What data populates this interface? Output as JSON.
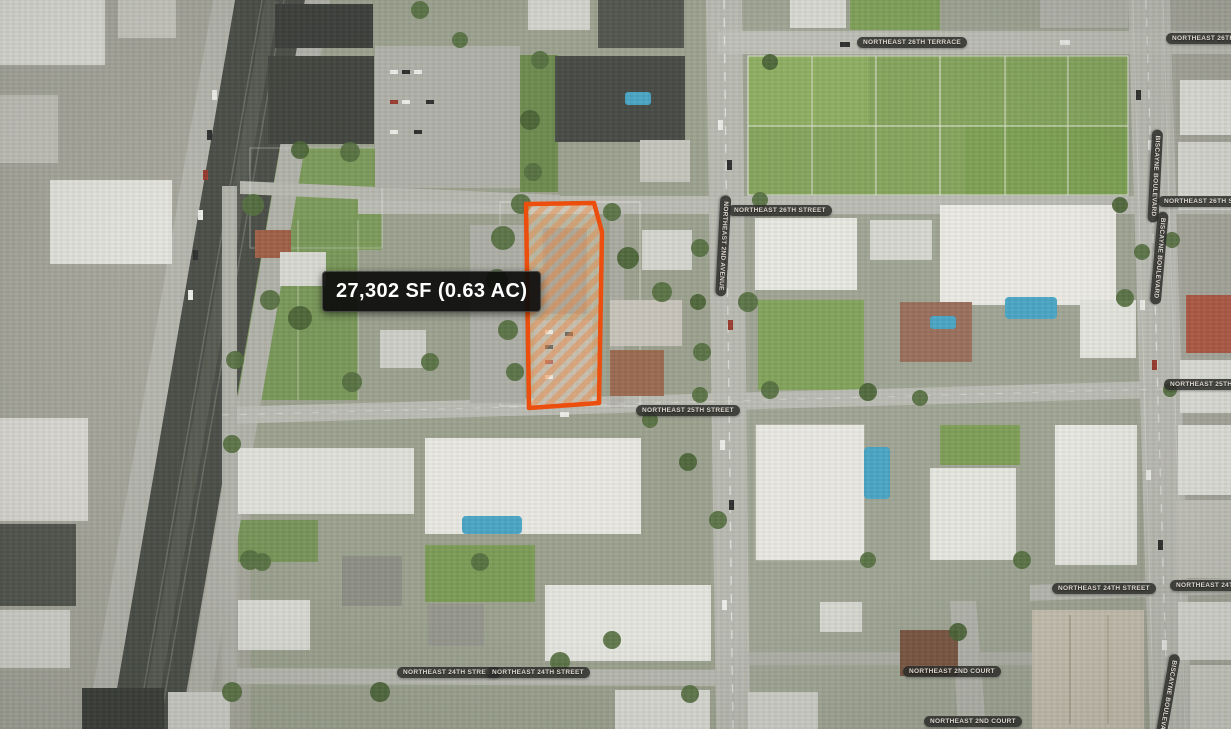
{
  "callout": {
    "text": "27,302 SF (0.63 AC)"
  },
  "parcel": {
    "area_sf": "27,302",
    "area_ac": "0.63",
    "outline_color": "#EB4E0D",
    "fill_style": "diagonal-orange-hatch"
  },
  "street_labels": [
    {
      "id": "ne-26th-terrace",
      "text": "NORTHEAST 26TH TERRACE",
      "orientation": "horizontal"
    },
    {
      "id": "ne-26th-terrace-right",
      "text": "NORTHEAST 26TH TERRACE",
      "orientation": "horizontal"
    },
    {
      "id": "ne-26th-street",
      "text": "NORTHEAST 26TH STREET",
      "orientation": "horizontal"
    },
    {
      "id": "ne-2nd-avenue",
      "text": "NORTHEAST 2ND AVENUE",
      "orientation": "vertical"
    },
    {
      "id": "ne-26th-street-right",
      "text": "NORTHEAST 26TH STREET",
      "orientation": "horizontal"
    },
    {
      "id": "biscayne-blvd-upper",
      "text": "BISCAYNE BOULEVARD",
      "orientation": "vertical"
    },
    {
      "id": "biscayne-blvd-mid",
      "text": "BISCAYNE BOULEVARD",
      "orientation": "vertical"
    },
    {
      "id": "ne-25th-street",
      "text": "NORTHEAST 25TH STREET",
      "orientation": "horizontal"
    },
    {
      "id": "ne-25th-street-right",
      "text": "NORTHEAST 25TH STREET",
      "orientation": "horizontal"
    },
    {
      "id": "ne-24th-street-right-a",
      "text": "NORTHEAST 24TH STREET",
      "orientation": "horizontal"
    },
    {
      "id": "ne-24th-street-right-b",
      "text": "NORTHEAST 24TH STREET",
      "orientation": "horizontal"
    },
    {
      "id": "ne-24th-street-a",
      "text": "NORTHEAST 24TH STREET",
      "orientation": "horizontal"
    },
    {
      "id": "ne-24th-street-b",
      "text": "NORTHEAST 24TH STREET",
      "orientation": "horizontal"
    },
    {
      "id": "ne-2nd-court",
      "text": "NORTHEAST 2ND COURT",
      "orientation": "horizontal"
    },
    {
      "id": "ne-2nd-court-bottom",
      "text": "NORTHEAST 2ND COURT",
      "orientation": "horizontal"
    },
    {
      "id": "biscayne-blvd-bottom",
      "text": "BISCAYNE BOULEVARD",
      "orientation": "vertical"
    }
  ],
  "colors": {
    "callout_bg": "#0C0C0C",
    "callout_text": "#FFFFFF",
    "label_bg": "rgba(44,43,41,0.85)",
    "label_text": "#DDD8D0",
    "parcel_outline": "#EB4E0D",
    "road": "#BCBDB5",
    "railway": "#4B4E48",
    "grass": "#84A45B",
    "pool_water": "#4AA6C6"
  }
}
